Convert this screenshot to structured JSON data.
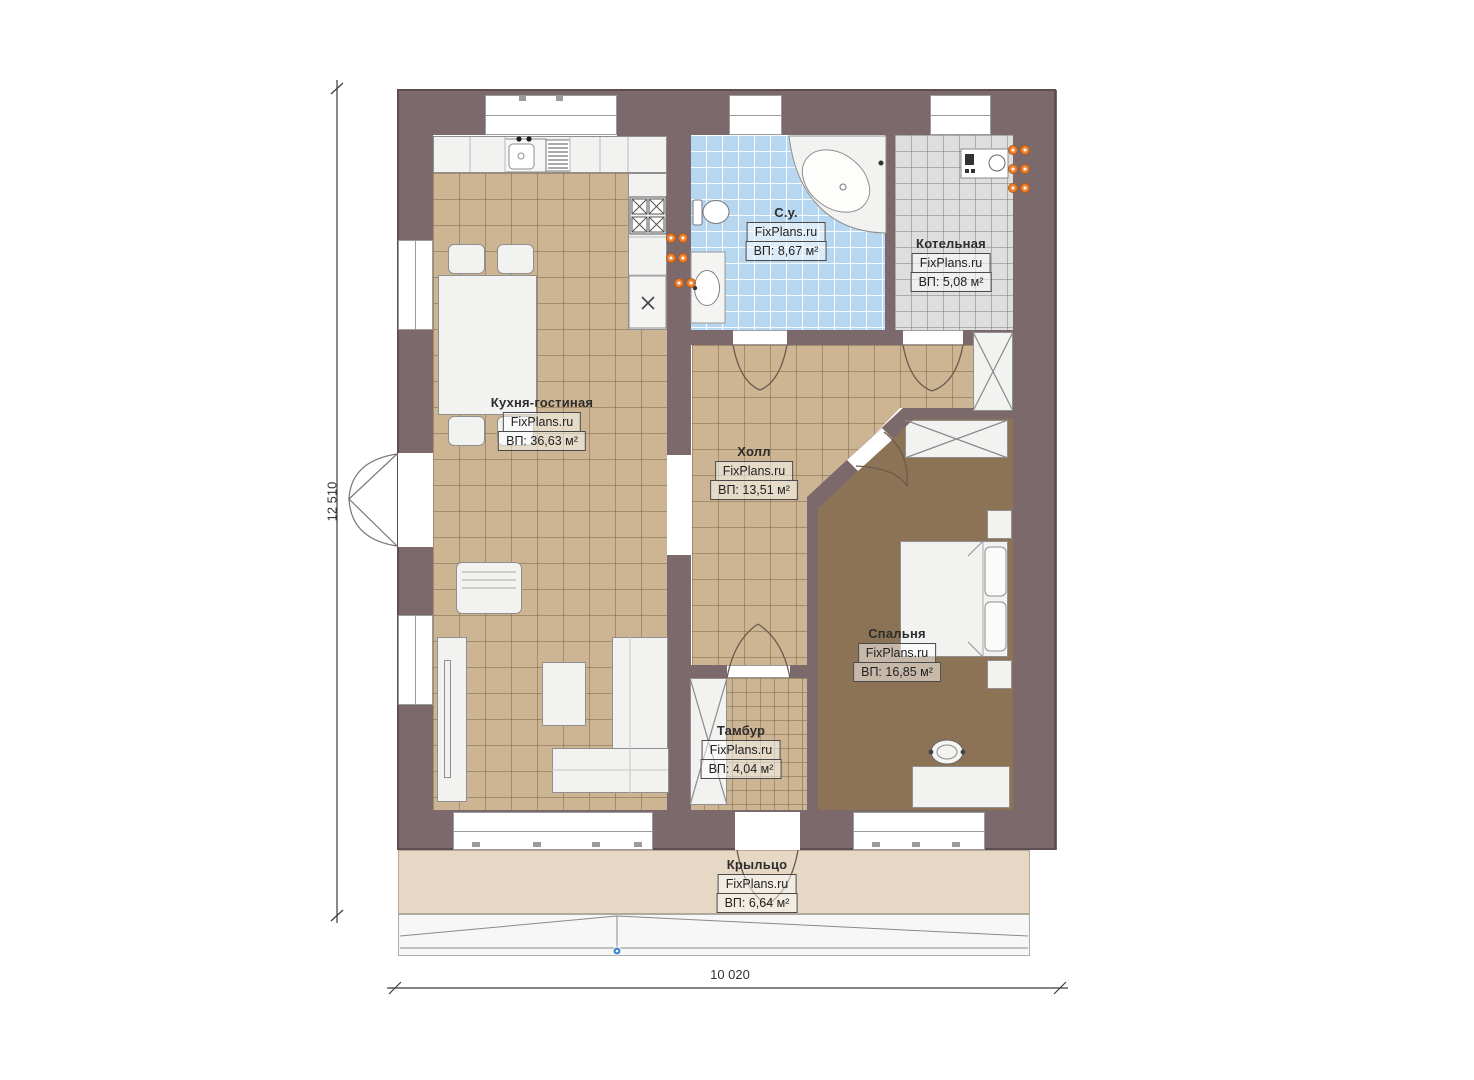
{
  "plan_title": "Floor plan",
  "brand": "FixPlans.ru",
  "rooms": [
    {
      "id": "kitchen_living",
      "name": "Кухня-гостиная",
      "area_label": "ВП: 36,63 м²"
    },
    {
      "id": "bathroom",
      "name": "С.у.",
      "area_label": "ВП: 8,67 м²"
    },
    {
      "id": "boiler",
      "name": "Котельная",
      "area_label": "ВП: 5,08 м²"
    },
    {
      "id": "hall",
      "name": "Холл",
      "area_label": "ВП: 13,51 м²"
    },
    {
      "id": "bedroom",
      "name": "Спальня",
      "area_label": "ВП: 16,85 м²"
    },
    {
      "id": "tambour",
      "name": "Тамбур",
      "area_label": "ВП: 4,04 м²"
    },
    {
      "id": "porch",
      "name": "Крыльцо",
      "area_label": "ВП: 6,64 м²"
    }
  ],
  "dimensions": {
    "width": "10 020",
    "height": "12 510"
  },
  "colors": {
    "wall": "#7c696b",
    "floor_tile_beige": "#cdb493",
    "floor_tile_blue": "#b7d6ef",
    "floor_tile_gray": "#dedede",
    "floor_bedroom_brown": "#8c7355",
    "porch": "#e6d8c4",
    "radiator_orange": "#ee8030",
    "survey_marker_blue": "#3f86d2"
  }
}
